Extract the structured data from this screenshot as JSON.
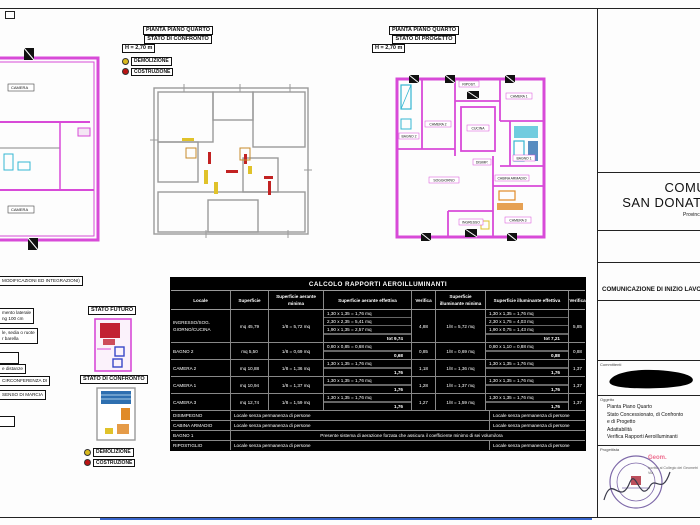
{
  "plan_labels": {
    "confronto": {
      "l1": "PIANTA PIANO QUARTO",
      "l2": "STATO DI CONFRONTO",
      "l3": "H = 2,70 m"
    },
    "progetto": {
      "l1": "PIANTA PIANO QUARTO",
      "l2": "STATO DI PROGETTO",
      "l3": "H = 2,70 m"
    }
  },
  "legend": {
    "demolizione": "DEMOLIZIONE",
    "costruzione": "COSTRUZIONE",
    "demolizione_color": "#d8b91c",
    "costruzione_color": "#bb1414"
  },
  "annotations": {
    "title": "MODIFICAZIONI ED INTEGRAZIONI)",
    "a1": "mento laterale",
    "a2": "ng 100 cm",
    "b1": "le, sedia o ruote",
    "b2": "r barella",
    "c": "e distanze",
    "d": "CIRCONFERENZA DI",
    "e": "SENSO DI MARCIA",
    "stato_futuro": "STATO FUTURO",
    "stato_confronto": "STATO DI CONFRONTO"
  },
  "plan_rooms": {
    "camera2": "CAMERA 2",
    "camera1": "CAMERA 1",
    "cucina": "CUCINA",
    "soggiorno": "SOGGIORNO",
    "camera3": "CAMERA 3",
    "ingresso": "INGRESSO",
    "bagno1": "BAGNO 1",
    "bagno2": "BAGNO 2",
    "ripostiglio": "RIPOST.",
    "cabina": "CABINA ARMADIO",
    "disimpegno": "DISIMP.",
    "camera_a": "CAMERA",
    "camera_b": "CAMERA"
  },
  "table": {
    "title": "CALCOLO RAPPORTI AEROILLUMINANTI",
    "headers": [
      "Locale",
      "Superficie",
      "Superficie aerante minima",
      "Superficie aerante effettiva",
      "Verifica",
      "Superficie illuminante minima",
      "Superficie illuminante effettiva",
      "Verifica"
    ],
    "rows": [
      {
        "type": "data",
        "locale": "INGRESSO/SOG.\nGIORNO/CUCINA",
        "sup": "mq  45,79",
        "aer_min": "1/8 =  5,72   mq",
        "aer_lines": [
          "1,30  x  1,35  =  1,76  mq",
          "2,30  x  2,35  =  5,41  mq",
          "1,90  x  1,35  =  2,57  mq"
        ],
        "aer_tot": "tot   9,74",
        "ver_a": "4,88",
        "ill_min": "1/8 =  5,72   mq",
        "ill_lines": [
          "1,30  x  1,35  =  1,76  mq",
          "2,30  x  1,75  =  4,03  mq",
          "1,90  x  0,75  =  1,43  mq"
        ],
        "ill_tot": "tot   7,21",
        "ver_i": "5,85"
      },
      {
        "type": "data",
        "locale": "BAGNO 2",
        "sup": "mq  5,50",
        "aer_min": "1/8 =  0,69   mq",
        "aer_lines": [
          "0,80  x  0,85  =  0,68  mq"
        ],
        "aer_tot": "0,68",
        "ver_a": "0,85",
        "ill_min": "1/8 =  0,69   mq",
        "ill_lines": [
          "0,80  x  1,10  =  0,88  mq"
        ],
        "ill_tot": "0,88",
        "ver_i": "0,88"
      },
      {
        "type": "data",
        "locale": "CAMERA 2",
        "sup": "mq  10,88",
        "aer_min": "1/8 =  1,36   mq",
        "aer_lines": [
          "1,30  x  1,35  =  1,76  mq"
        ],
        "aer_tot": "1,76",
        "ver_a": "1,18",
        "ill_min": "1/8 =  1,36   mq",
        "ill_lines": [
          "1,30  x  1,35  =  1,76  mq"
        ],
        "ill_tot": "1,76",
        "ver_i": "1,37"
      },
      {
        "type": "data",
        "locale": "CAMERA 1",
        "sup": "mq  10,94",
        "aer_min": "1/8 =  1,37   mq",
        "aer_lines": [
          "1,30  x  1,35  =  1,76  mq"
        ],
        "aer_tot": "1,76",
        "ver_a": "1,28",
        "ill_min": "1/8 =  1,37   mq",
        "ill_lines": [
          "1,30  x  1,35  =  1,76  mq"
        ],
        "ill_tot": "1,76",
        "ver_i": "1,37"
      },
      {
        "type": "data",
        "locale": "CAMERA 3",
        "sup": "mq  12,74",
        "aer_min": "1/8 =  1,59   mq",
        "aer_lines": [
          "1,30  x  1,35  =  1,76  mq"
        ],
        "aer_tot": "1,76",
        "ver_a": "1,27",
        "ill_min": "1/8 =  1,59   mq",
        "ill_lines": [
          "1,30  x  1,35  =  1,76  mq"
        ],
        "ill_tot": "1,76",
        "ver_i": "1,37"
      },
      {
        "type": "span2",
        "locale": "DISIMPEGNO",
        "left": "Locale senza permanenza di persone",
        "right": "Locale senza permanenza di persone"
      },
      {
        "type": "span2",
        "locale": "CABINA ARMADIO",
        "left": "Locale senza permanenza di persone",
        "right": "Locale senza permanenza di persone"
      },
      {
        "type": "span1",
        "locale": "BAGNO 1",
        "text": "Presente sistema di aerazione forzata che assicura il coefficiente minimo di sei volumi/ora"
      },
      {
        "type": "span2",
        "locale": "RIPOSTIGLIO",
        "left": "Locale senza permanenza di persone",
        "right": "Locale senza permanenza di persone"
      }
    ]
  },
  "titleblock": {
    "comune_line1": "COMUNE DI",
    "comune_line2": "SAN DONATO MILANESE",
    "provincia": "Provincia di Milano",
    "pratica": "COMUNICAZIONE DI INIZIO LAVORI",
    "committenti_label": "Committenti",
    "oggetto_label": "Oggetto",
    "oggetto_lines": [
      "Pianta Piano Quarto",
      "Stato Concessionato, di Confronto",
      "e di Progetto",
      "Adattabilità",
      "Verifica Rapporti Aeroilluminanti"
    ],
    "progettista_label": "Progettista",
    "geom_name": "Geom.",
    "geom_line1": "Iscritto al Collegio dei Geometri",
    "geom_line2": "Via",
    "geom_color": "#ee6f90"
  },
  "colors": {
    "wall_magenta": "#d84ad8",
    "wall_gray": "#9a9a9a",
    "blue_bottom_line": "#3a66cc"
  }
}
